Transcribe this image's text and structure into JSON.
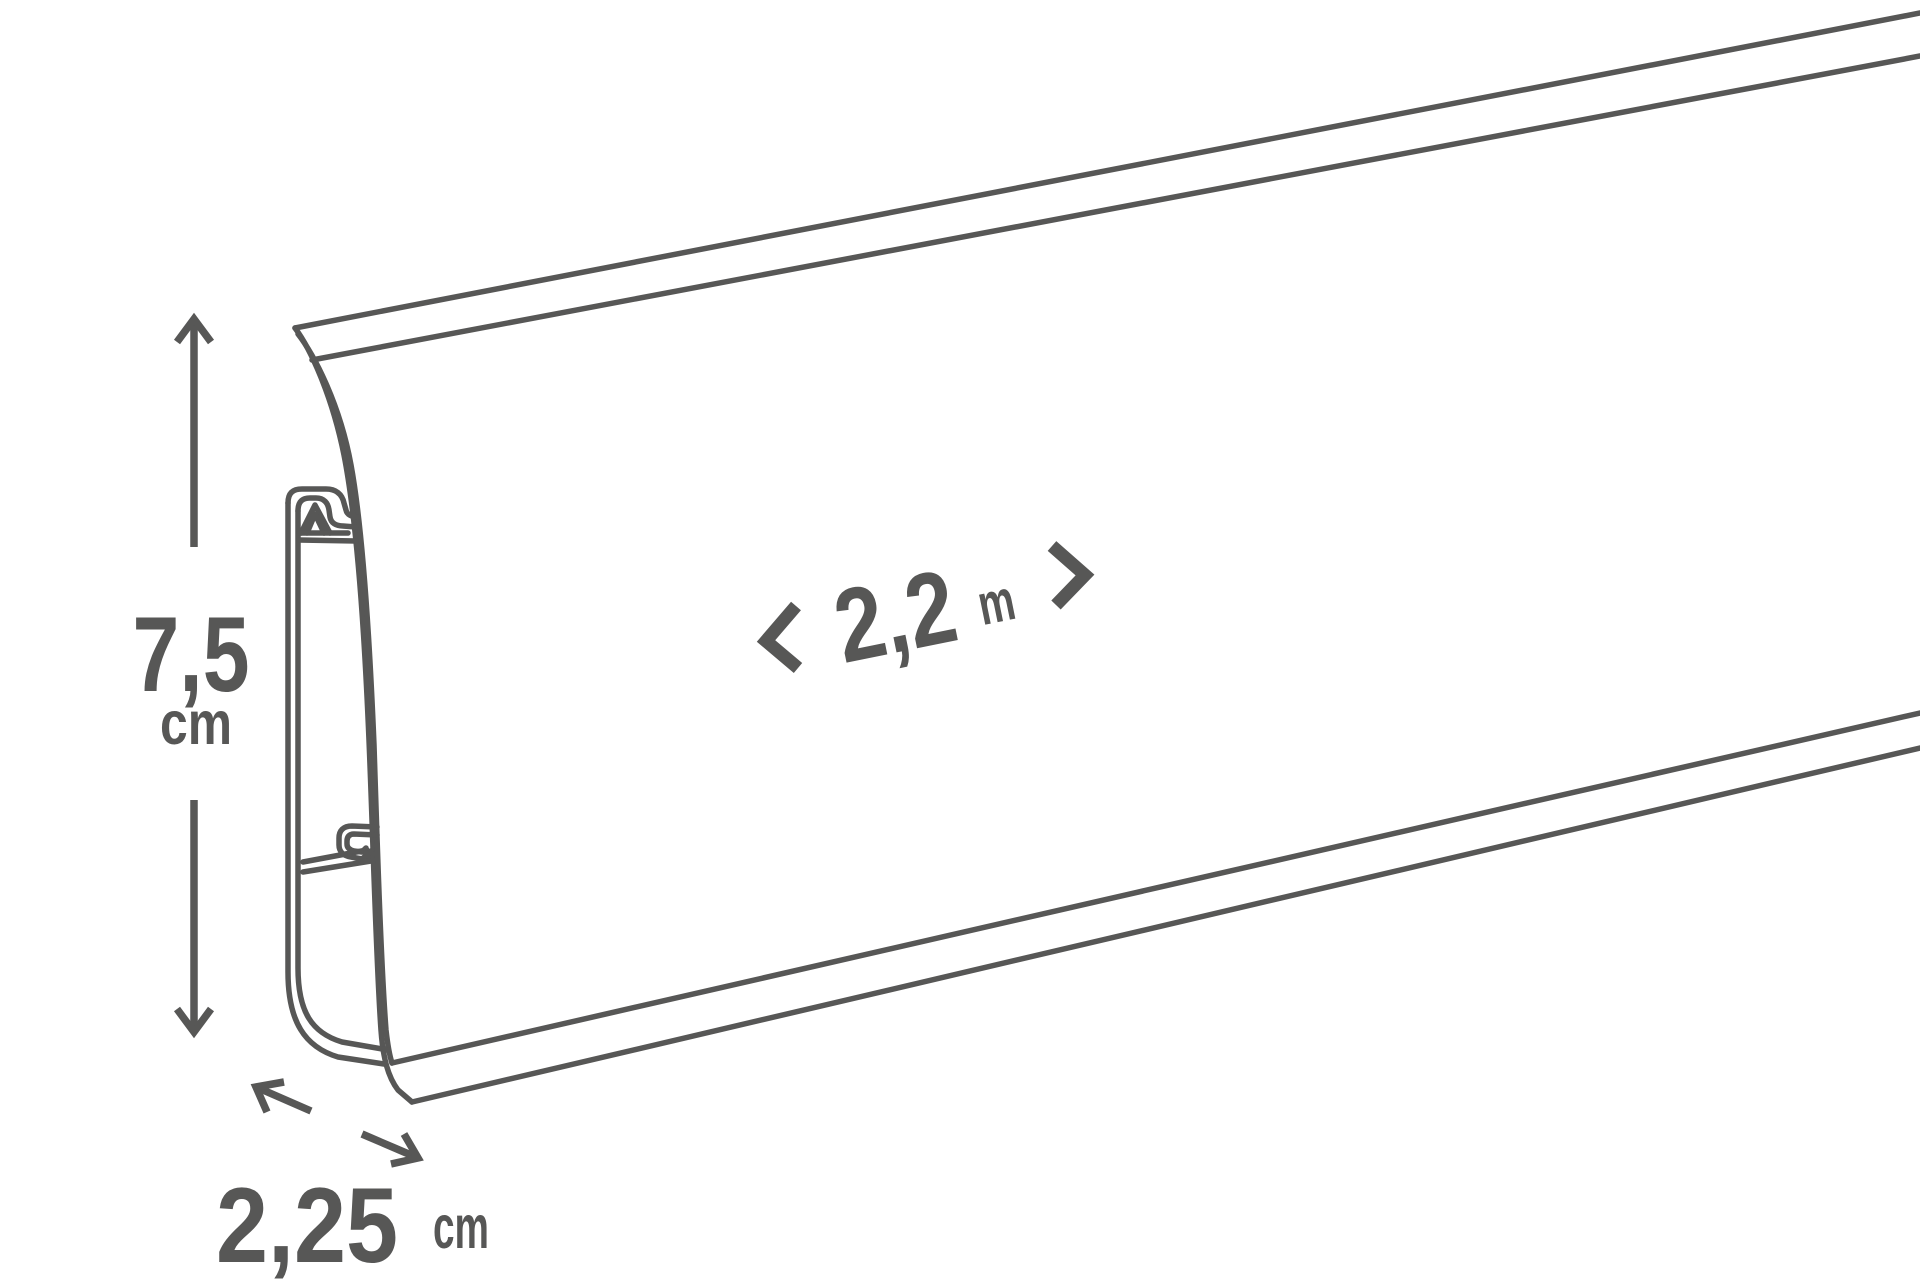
{
  "diagram": {
    "kind": "skirting-board-dimension-diagram",
    "background_color": "#ffffff",
    "line_color": "#575756",
    "dimensions": {
      "height": {
        "value": "7,5",
        "unit": "cm"
      },
      "depth": {
        "value": "2,25",
        "unit": "cm"
      },
      "length": {
        "value": "2,2",
        "unit": "m"
      }
    },
    "icons": [
      "up-arrowhead-icon",
      "down-arrowhead-icon",
      "up-left-arrowhead-icon",
      "down-right-arrowhead-icon",
      "left-chevron-icon",
      "right-chevron-icon"
    ]
  }
}
